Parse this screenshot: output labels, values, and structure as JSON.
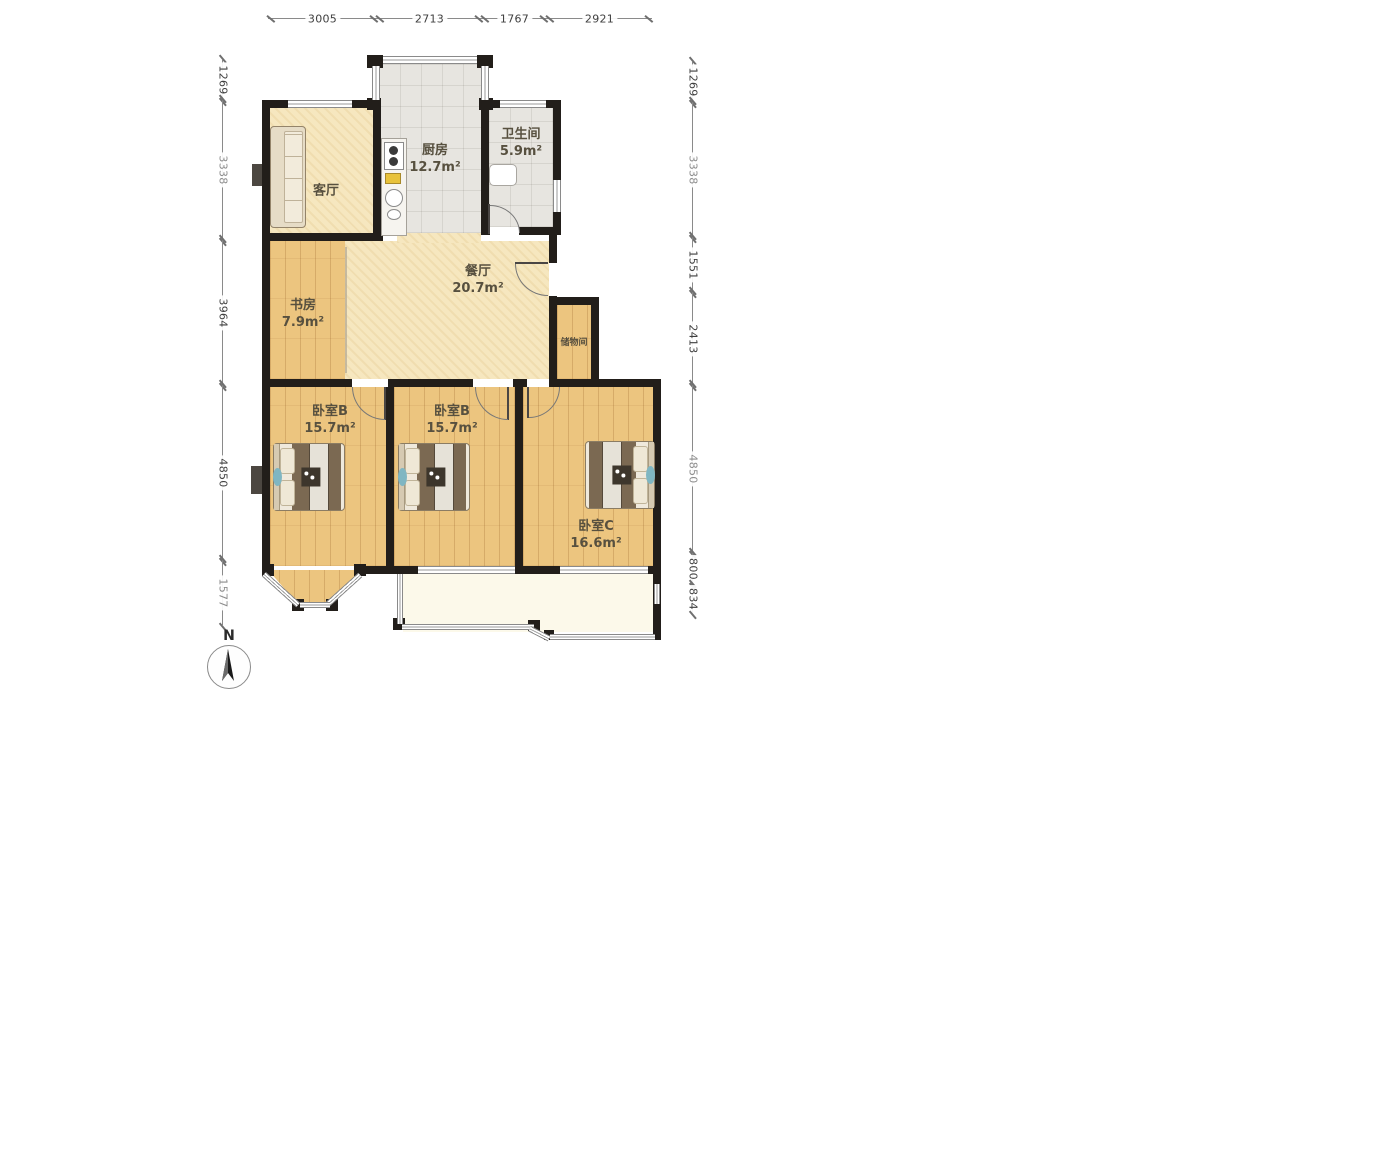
{
  "title": "apartment-floor-plan",
  "compass": {
    "label": "N"
  },
  "rooms": {
    "living": {
      "name": "客厅",
      "area": ""
    },
    "kitchen": {
      "name": "厨房",
      "area": "12.7m²"
    },
    "bathroom": {
      "name": "卫生间",
      "area": "5.9m²"
    },
    "dining": {
      "name": "餐厅",
      "area": "20.7m²"
    },
    "study": {
      "name": "书房",
      "area": "7.9m²"
    },
    "storage": {
      "name": "储物间",
      "area": ""
    },
    "bedroom_b1": {
      "name": "卧室B",
      "area": "15.7m²"
    },
    "bedroom_b2": {
      "name": "卧室B",
      "area": "15.7m²"
    },
    "bedroom_c": {
      "name": "卧室C",
      "area": "16.6m²"
    }
  },
  "dimensions": {
    "top": [
      "3005",
      "2713",
      "1767",
      "2921"
    ],
    "left": [
      "1269",
      "3338",
      "3964",
      "4850",
      "1577"
    ],
    "right": [
      "1269",
      "3338",
      "1551",
      "2413",
      "4850",
      "800",
      "834"
    ]
  },
  "colors": {
    "wall": "#221e1a",
    "wood_floor": "#ecc57f",
    "cream_floor": "#f6e7bf",
    "tile_floor": "#e7e5e0",
    "balcony_floor": "#fcf9ea",
    "blanket": "#7b6952",
    "accent_teal": "#7fb6c2"
  }
}
